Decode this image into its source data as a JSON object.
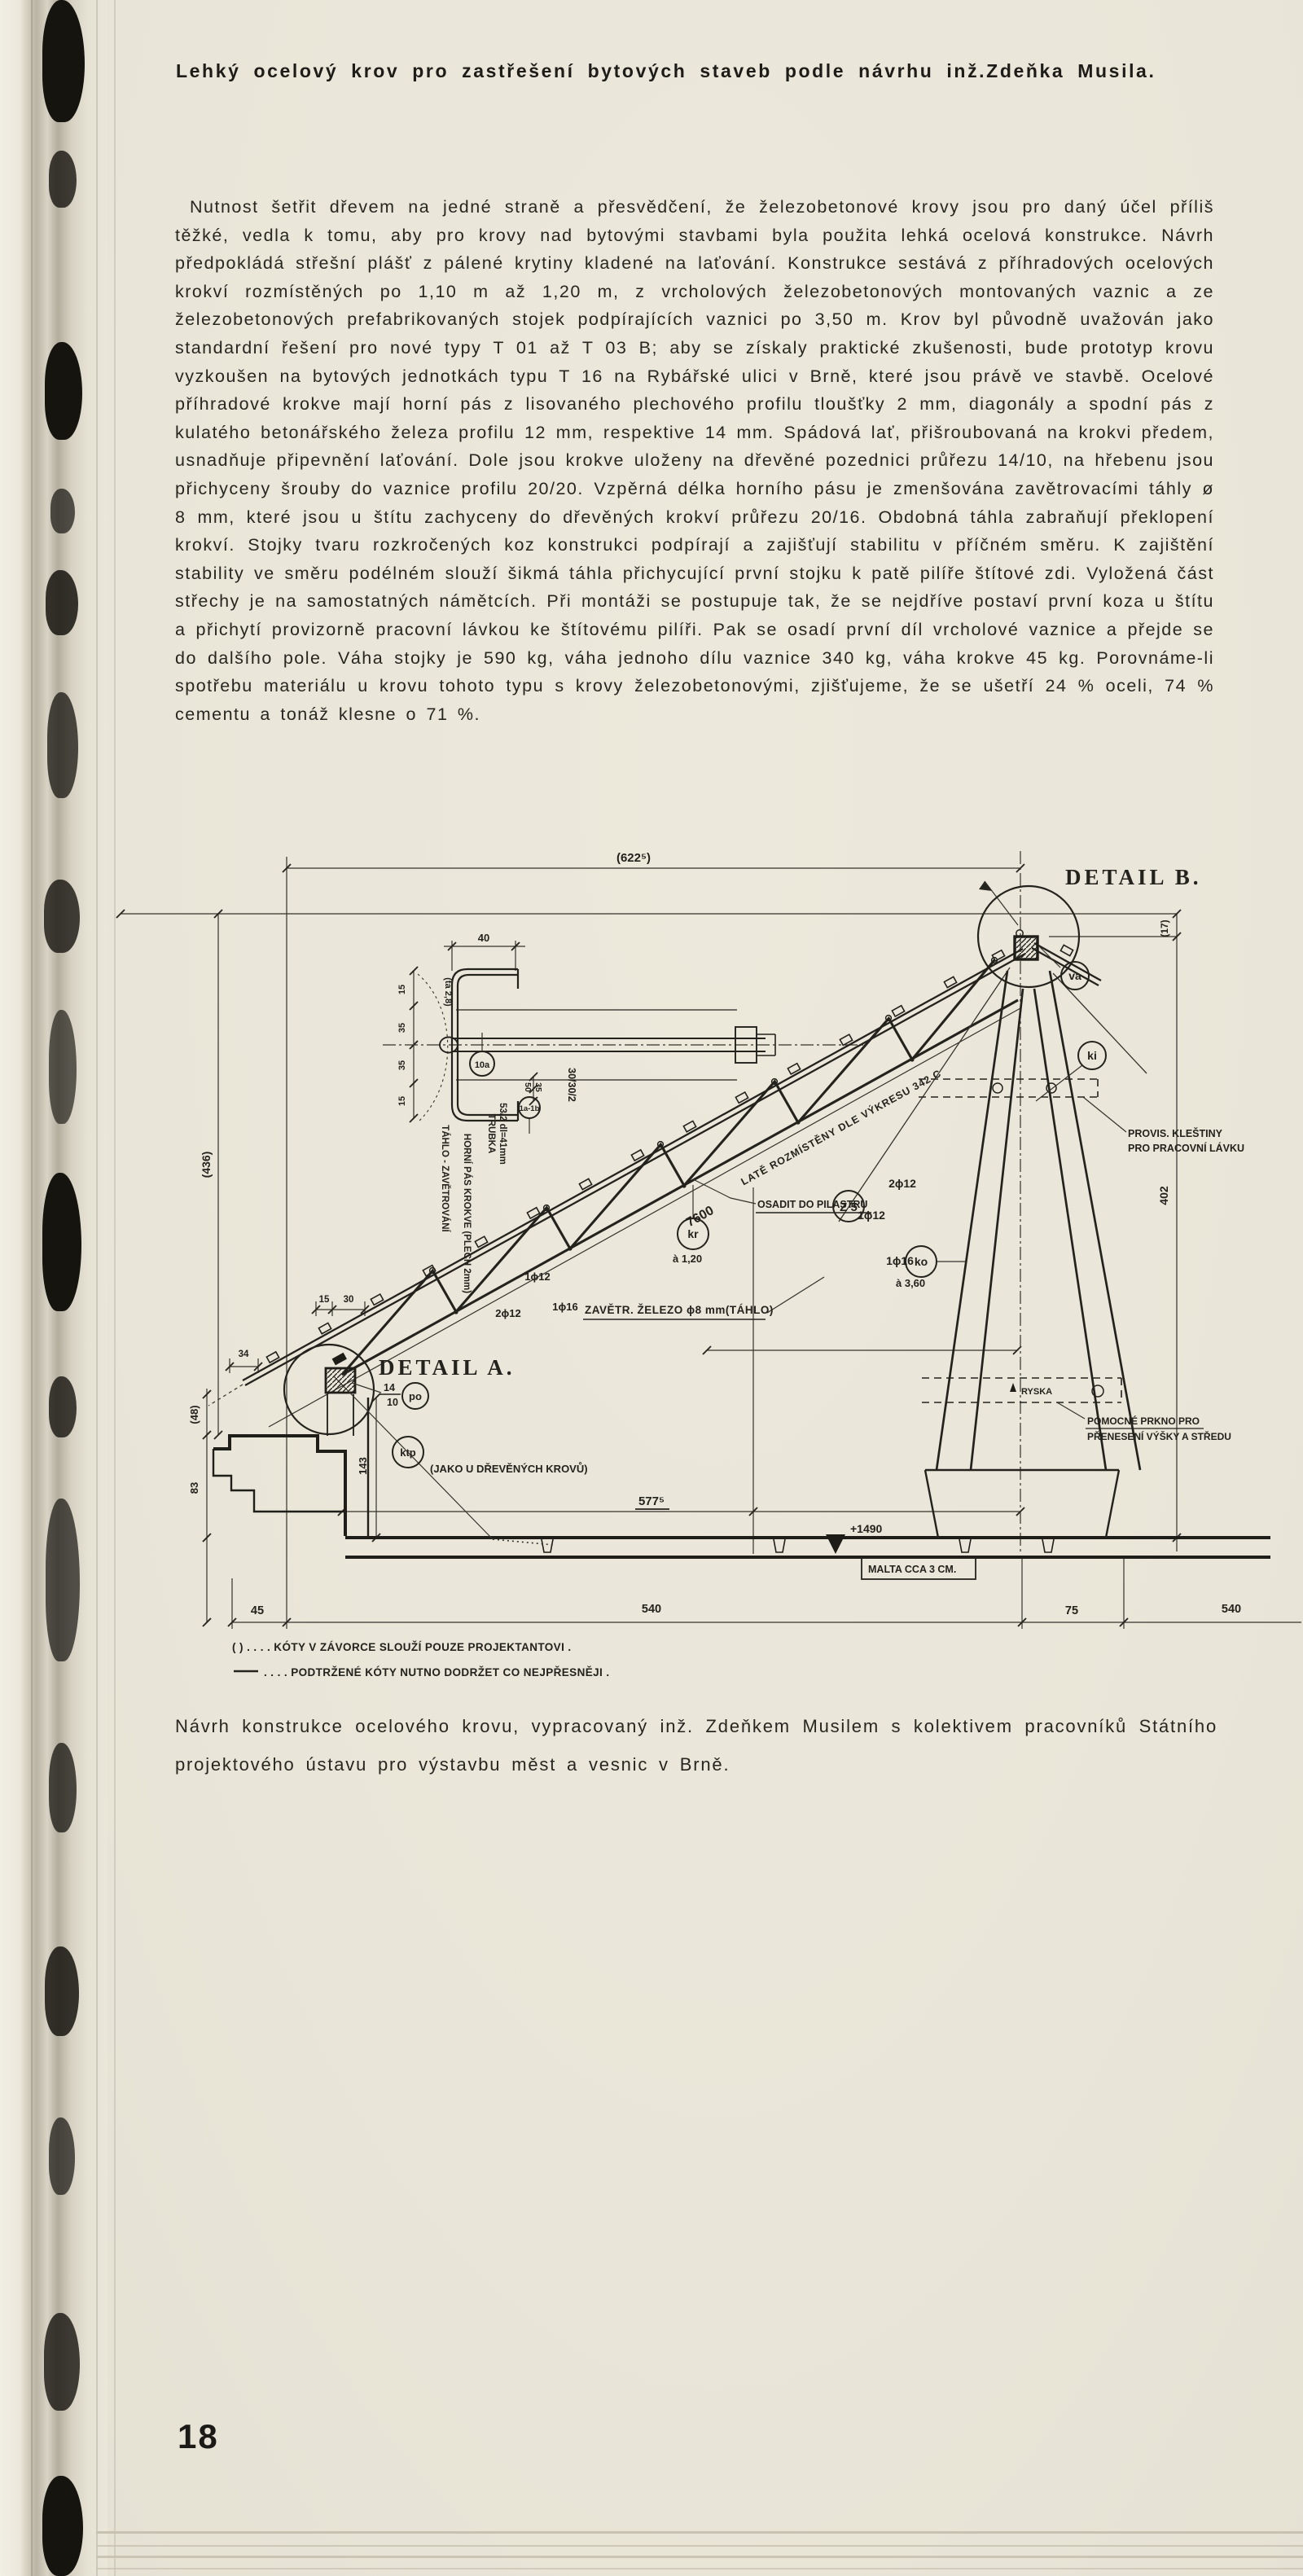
{
  "page": {
    "title": "Lehký ocelový krov pro zastřešení bytových staveb podle návrhu inž.Zdeňka Musila.",
    "body_text": "Nutnost šetřit dřevem na jedné straně a přesvědčení, že železobetonové krovy jsou pro daný účel příliš těžké, vedla k tomu, aby pro krovy nad bytovými stavbami byla použita lehká ocelová konstrukce. Návrh předpokládá střešní plášť z pálené krytiny kladené na laťování. Konstrukce sestává z příhradových ocelových krokví rozmístěných po 1,10 m až 1,20 m, z vrcholových železobetonových montovaných vaznic a ze železobetonových prefabrikovaných stojek podpírajících vaznici po 3,50 m. Krov byl původně uvažován jako standardní řešení pro nové typy T 01 až T 03 B; aby se získaly praktické zkušenosti, bude prototyp krovu vyzkoušen na bytových jednotkách typu T 16 na Rybářské ulici v Brně, které jsou právě ve stavbě. Ocelové příhradové krokve mají horní pás z lisovaného plechového profilu tloušťky 2 mm, diagonály a spodní pás z kulatého betonářského železa profilu 12 mm, respektive 14 mm. Spádová lať, přišroubovaná na krokvi předem, usnadňuje připevnění laťování. Dole jsou krokve uloženy na dřevěné pozednici průřezu 14/10, na hřebenu jsou přichyceny šrouby do vaznice profilu 20/20. Vzpěrná délka horního pásu je zmenšována zavětrovacími táhly ø 8 mm, které jsou u štítu zachyceny do dřevěných krokví průřezu 20/16. Obdobná táhla zabraňují překlopení krokví. Stojky tvaru rozkročených koz konstrukci podpírají a zajišťují stabilitu v příčném směru. K zajištění stability ve směru podélném slouží šikmá táhla přichycující první stojku k patě pilíře štítové zdi. Vyložená část střechy je na samostatných námětcích. Při montáži se postupuje tak, že se nejdříve postaví první koza u štítu a přichytí provizorně pracovní lávkou ke štítovému pilíři. Pak se osadí první díl vrcholové vaznice a přejde se do dalšího pole. Váha stojky je 590 kg, váha jednoho dílu vaznice 340 kg, váha krokve 45 kg. Porovnáme-li spotřebu materiálu u krovu tohoto typu s krovy železobetonovými, zjišťujeme, že se ušetří 24 % oceli, 74 % cementu a tonáž klesne o 71 %.",
    "caption": "Návrh konstrukce ocelového krovu, vypracovaný inž. Zdeňkem Musilem s kolektivem pracovníků Státního projektového ústavu pro výstavbu měst a vesnic v Brně.",
    "page_number": "18"
  },
  "drawing": {
    "detail_a": "DETAIL A.",
    "detail_b": "DETAIL B.",
    "dims": {
      "span": "(622⁵)",
      "d17": "(17)",
      "h436": "(436)",
      "h402": "402",
      "len7600": "7600",
      "w40": "40",
      "p15a": "15",
      "p35a": "35",
      "p35b": "35",
      "p15b": "15",
      "ta28": "(ta 2,8)",
      "d50": "50",
      "d35": "35",
      "prof30": "30/30/2",
      "e15": "15",
      "e30": "30",
      "e34": "34",
      "h48": "(48)",
      "h83": "83",
      "h143": "143",
      "poz_top": "14",
      "poz_bot": "10",
      "d5775": "577⁵",
      "elev": "+1490",
      "b45": "45",
      "b540a": "540",
      "b75": "75",
      "b540b": "540"
    },
    "labels": {
      "zavetr": "ZAVĚTR. ŽELEZO ϕ8 mm(TÁHLO)",
      "late": "LATĚ ROZMÍSTĚNY DLE VÝKRESU 342 C",
      "trubka1": "TRUBKA",
      "trubka2": "53/2 dl=41mm",
      "horni_pas": "HORNÍ PÁS KROKVE (PLECH 2mm)",
      "tahlo": "TÁHLO - ZAVĚTROVÁNÍ",
      "osadit": "OSADIT DO PILASTRU",
      "provis1": "PROVIS. KLEŠTINY",
      "provis2": "PRO PRACOVNÍ LÁVKU",
      "pomocne1": "POMOCNÉ PRKNO PRO",
      "pomocne2": "PŘENESENÍ VÝŠKY A STŘEDU",
      "ryska": "RYSKA",
      "malta": "MALTA CCA 3 CM.",
      "jako": "(JAKO U DŘEVĚNÝCH KROVŮ)",
      "rod_u1": "2ϕ12",
      "rod_u2": "1ϕ12",
      "rod_u3": "1ϕ16",
      "rod_l1": "1ϕ12",
      "rod_l2": "2ϕ12",
      "rod_l3": "1ϕ16"
    },
    "balloons": {
      "va": "va",
      "ki": "ki",
      "kr": "kr",
      "ko": "ko",
      "po": "po",
      "ktp": "ktp",
      "z5": "Z 5",
      "n10a": "10a",
      "n1ab": "1a-1b"
    },
    "spacing": {
      "a120": "à 1,20",
      "a360": "à 3,60"
    },
    "notes": {
      "n1": "(  ) . . . . KÓTY V ZÁVORCE SLOUŽÍ POUZE PROJEKTANTOVI .",
      "n2": ". . . . PODTRŽENÉ KÓTY NUTNO DODRŽET CO NEJPŘESNĚJI ."
    }
  }
}
